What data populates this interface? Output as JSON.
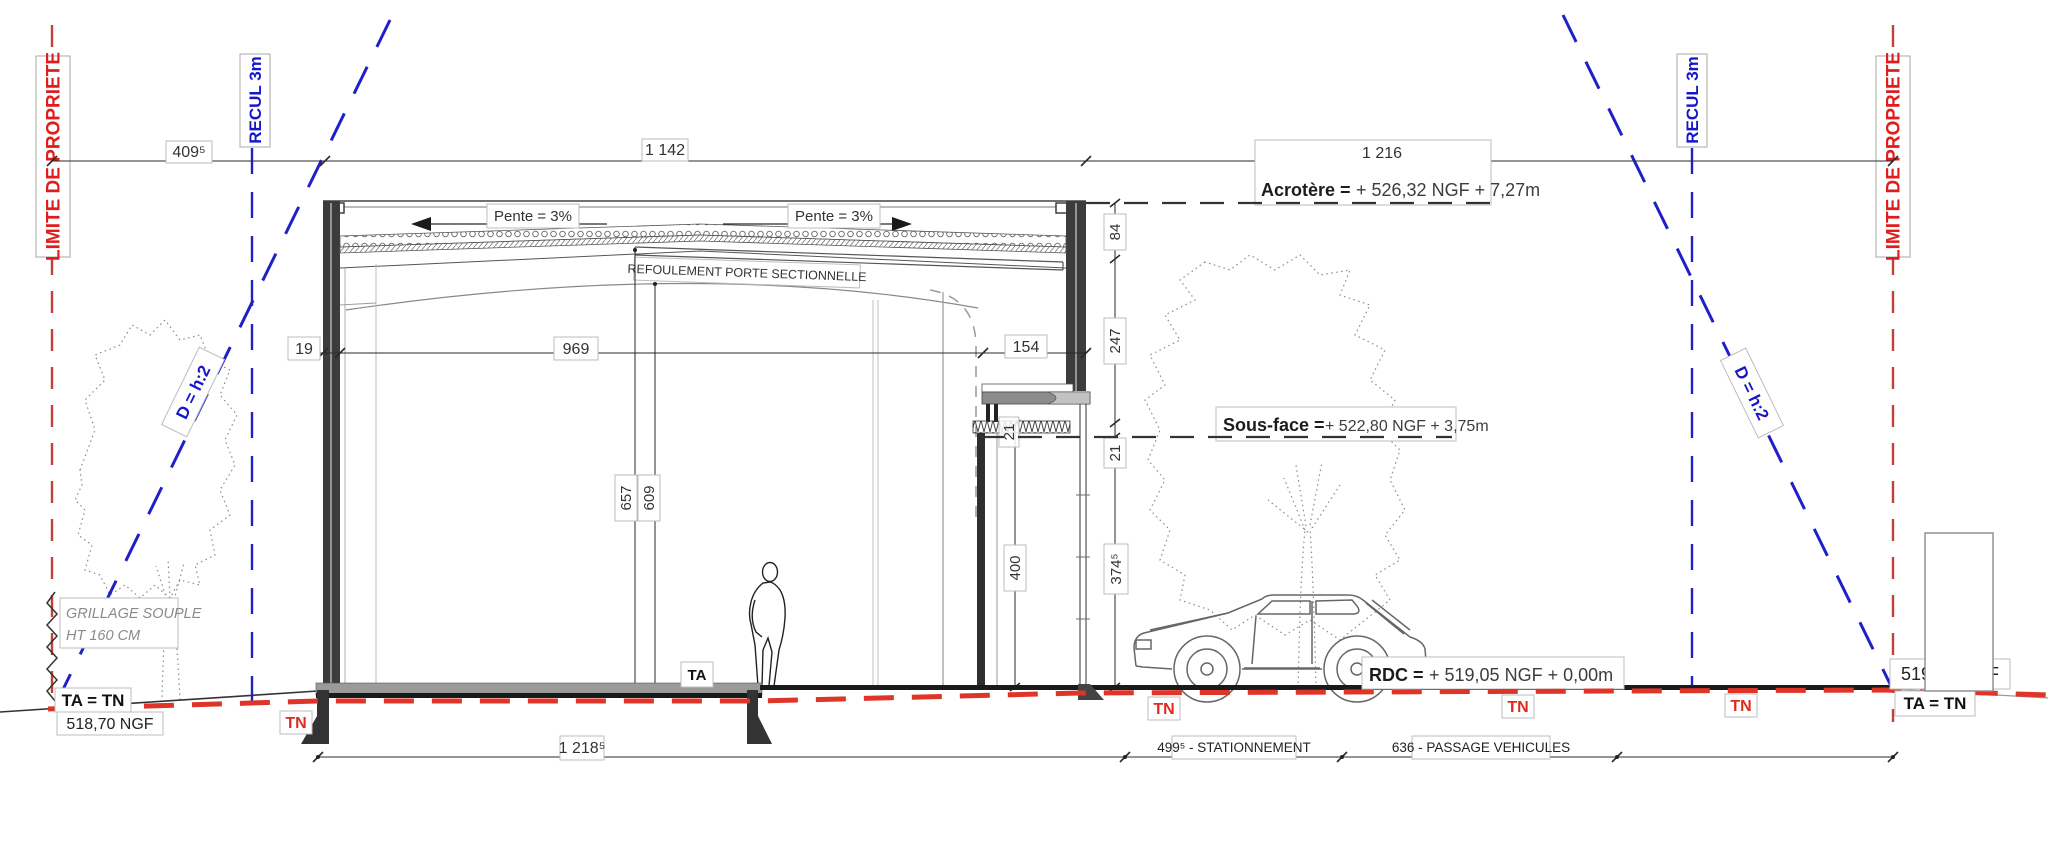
{
  "boundary": {
    "limite": "LIMITE DE PROPRIETE",
    "recul": "RECUL 3m",
    "slope_rule": "D = h:2"
  },
  "top_dims": {
    "d1": "409⁵",
    "d2": "1 142",
    "d3": "1 216"
  },
  "levels": {
    "acrotere_label": "Acrotère =",
    "acrotere_value": "+ 526,32 NGF + 7,27m",
    "sousface_label": "Sous-face =",
    "sousface_value": "+ 522,80 NGF + 3,75m",
    "rdc_label": "RDC =",
    "rdc_value": "+ 519,05 NGF  + 0,00m"
  },
  "roof": {
    "pente": "Pente = 3%",
    "refoulement": "REFOULEMENT PORTE SECTIONNELLE"
  },
  "dims": {
    "wall": "19",
    "interior": "969",
    "entry": "154",
    "parapet": "84",
    "facade_upper": "247",
    "canopy": "21",
    "hall_clear": "657",
    "door_clear": "609",
    "opening": "400",
    "under_canopy": "374⁵"
  },
  "ground": {
    "ta": "TA",
    "tn": "TN",
    "ta_tn": "TA = TN",
    "ngf_left": "518,70 NGF",
    "ngf_right": "519,05 NGF",
    "grillage1": "GRILLAGE SOUPLE",
    "grillage2": "HT 160 CM"
  },
  "bottom_dims": {
    "slab": "1 218⁵",
    "parking": "499⁵ - STATIONNEMENT",
    "passage": "636 - PASSAGE VEHICULES"
  },
  "colors": {
    "property_red": "#e01c1c",
    "setback_blue": "#1717c9",
    "terrain_red": "#df3428",
    "line_dark": "#2a2a2a"
  }
}
